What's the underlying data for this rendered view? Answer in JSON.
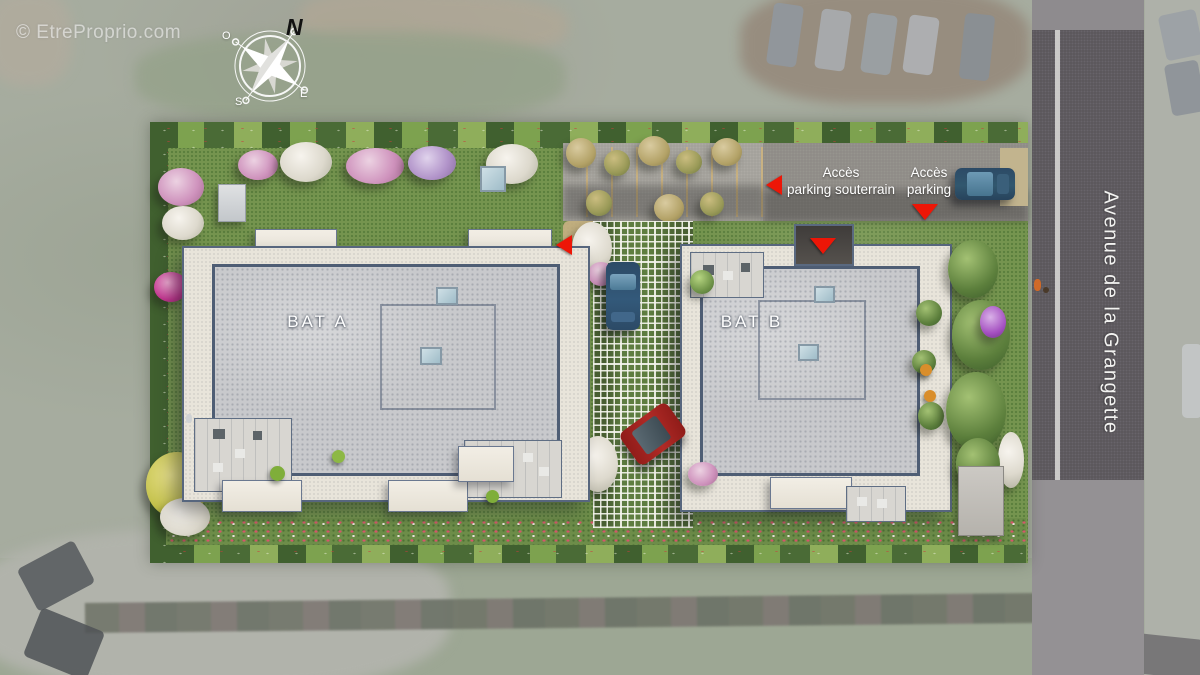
{
  "watermark": {
    "text": "© EtreProprio.com"
  },
  "compass": {
    "north": "N",
    "south": "S",
    "east": "E",
    "west": "O"
  },
  "site": {
    "building_a": {
      "label": "BAT A"
    },
    "building_b": {
      "label": "BAT B"
    }
  },
  "annotations": {
    "underground_access": {
      "line1": "Accès",
      "line2": "parking souterrain"
    },
    "surface_access": {
      "line1": "Accès",
      "line2": "parking"
    }
  },
  "street": {
    "name": "Avenue de la Grangette"
  },
  "colors": {
    "marker_red": "#ed1607",
    "roof_gray": "#c8c9cc",
    "parapet_blue_gray": "#4e5d74",
    "terrace_cream": "#e8e4da",
    "lawn_green": "#75944f",
    "hedge_dark_green": "#40602f",
    "grass_paver_green": "#5e7d40",
    "road_asphalt": "#59555a",
    "background_muted": "#a6ac9f",
    "car_blue": "#33597a",
    "car_red": "#a8201d",
    "label_white": "#ffffff"
  }
}
